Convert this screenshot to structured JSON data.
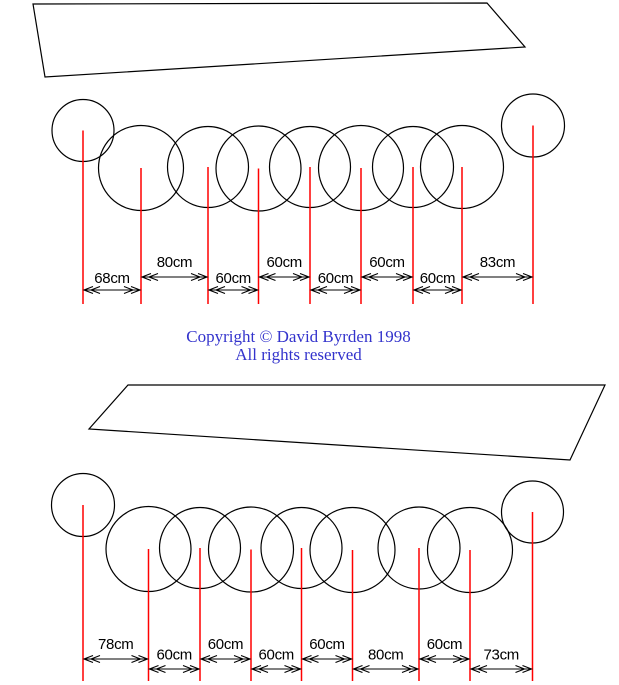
{
  "page": {
    "width": 619,
    "height": 685,
    "background": "#ffffff"
  },
  "colors": {
    "outline": "#000000",
    "marker_line": "#ff0000",
    "dimension": "#000000",
    "copyright": "#3333cc",
    "background": "#ffffff"
  },
  "copyright": {
    "line1": "Copyright © David Byrden 1998",
    "line2": "All rights reserved"
  },
  "diagrams": [
    {
      "name": "top-arrangement",
      "table": {
        "points": [
          [
            33,
            4
          ],
          [
            487,
            3
          ],
          [
            525,
            47
          ],
          [
            45,
            77
          ]
        ]
      },
      "circles": [
        {
          "cx": 83,
          "cy": 130.5,
          "r": 31
        },
        {
          "cx": 141,
          "cy": 168,
          "r": 42.5
        },
        {
          "cx": 208,
          "cy": 167,
          "r": 40.5
        },
        {
          "cx": 258.5,
          "cy": 168.5,
          "r": 42.5
        },
        {
          "cx": 310,
          "cy": 167,
          "r": 40.5
        },
        {
          "cx": 361,
          "cy": 168,
          "r": 42.5
        },
        {
          "cx": 413,
          "cy": 167,
          "r": 40.5
        },
        {
          "cx": 462,
          "cy": 167,
          "r": 41.5
        },
        {
          "cx": 533,
          "cy": 125.5,
          "r": 31.5
        }
      ],
      "marker_line_bottom_y": 304,
      "rows": {
        "high": {
          "label_y": 267,
          "arrow_y": 277
        },
        "low": {
          "label_y": 283,
          "arrow_y": 290
        }
      },
      "dimensions": [
        {
          "x1": 83,
          "x2": 141,
          "label": "68cm",
          "row": "low"
        },
        {
          "x1": 141,
          "x2": 208,
          "label": "80cm",
          "row": "high"
        },
        {
          "x1": 208,
          "x2": 258.5,
          "label": "60cm",
          "row": "low"
        },
        {
          "x1": 258.5,
          "x2": 310,
          "label": "60cm",
          "row": "high"
        },
        {
          "x1": 310,
          "x2": 361,
          "label": "60cm",
          "row": "low"
        },
        {
          "x1": 361,
          "x2": 413,
          "label": "60cm",
          "row": "high"
        },
        {
          "x1": 413,
          "x2": 462,
          "label": "60cm",
          "row": "low"
        },
        {
          "x1": 462,
          "x2": 533,
          "label": "83cm",
          "row": "high"
        }
      ]
    },
    {
      "name": "bottom-arrangement",
      "table": {
        "points": [
          [
            128,
            385
          ],
          [
            605,
            385
          ],
          [
            570,
            460
          ],
          [
            89,
            429
          ]
        ]
      },
      "circles": [
        {
          "cx": 83,
          "cy": 505,
          "r": 31.5
        },
        {
          "cx": 148.5,
          "cy": 549,
          "r": 42.5
        },
        {
          "cx": 200,
          "cy": 548,
          "r": 40.5
        },
        {
          "cx": 251,
          "cy": 549.5,
          "r": 42.5
        },
        {
          "cx": 301.5,
          "cy": 548,
          "r": 40.5
        },
        {
          "cx": 352.5,
          "cy": 550,
          "r": 42.5
        },
        {
          "cx": 419,
          "cy": 548,
          "r": 41
        },
        {
          "cx": 470,
          "cy": 550,
          "r": 42.5
        },
        {
          "cx": 532.5,
          "cy": 512,
          "r": 31
        }
      ],
      "marker_line_bottom_y": 681,
      "rows": {
        "high": {
          "label_y": 649,
          "arrow_y": 659
        },
        "low": {
          "label_y": 659.5,
          "arrow_y": 669
        }
      },
      "dimensions": [
        {
          "x1": 83,
          "x2": 148.5,
          "label": "78cm",
          "row": "high"
        },
        {
          "x1": 148.5,
          "x2": 200,
          "label": "60cm",
          "row": "low"
        },
        {
          "x1": 200,
          "x2": 251,
          "label": "60cm",
          "row": "high"
        },
        {
          "x1": 251,
          "x2": 301.5,
          "label": "60cm",
          "row": "low"
        },
        {
          "x1": 301.5,
          "x2": 352.5,
          "label": "60cm",
          "row": "high"
        },
        {
          "x1": 352.5,
          "x2": 419,
          "label": "80cm",
          "row": "low"
        },
        {
          "x1": 419,
          "x2": 470,
          "label": "60cm",
          "row": "high"
        },
        {
          "x1": 470,
          "x2": 532.5,
          "label": "73cm",
          "row": "low"
        }
      ]
    }
  ]
}
